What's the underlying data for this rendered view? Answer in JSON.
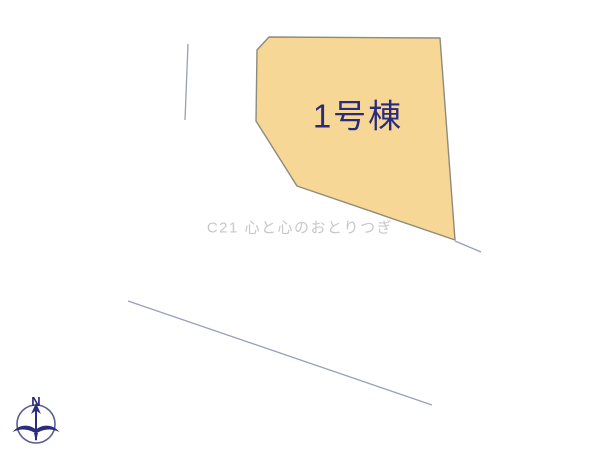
{
  "canvas": {
    "background_color": "#ffffff",
    "width": 600,
    "height": 450
  },
  "lot": {
    "label": "1号棟",
    "fill_color": "#f7d795",
    "border_color": "#8f8a7c",
    "label_color": "#2b2b7e"
  },
  "watermark": {
    "text": "C21 心と心のおとりつぎ",
    "color": "#c8c8c8"
  },
  "compass": {
    "north_label": "N",
    "color": "#2a2d7c"
  },
  "boundary_lines": {
    "color": "#98a0b6"
  }
}
